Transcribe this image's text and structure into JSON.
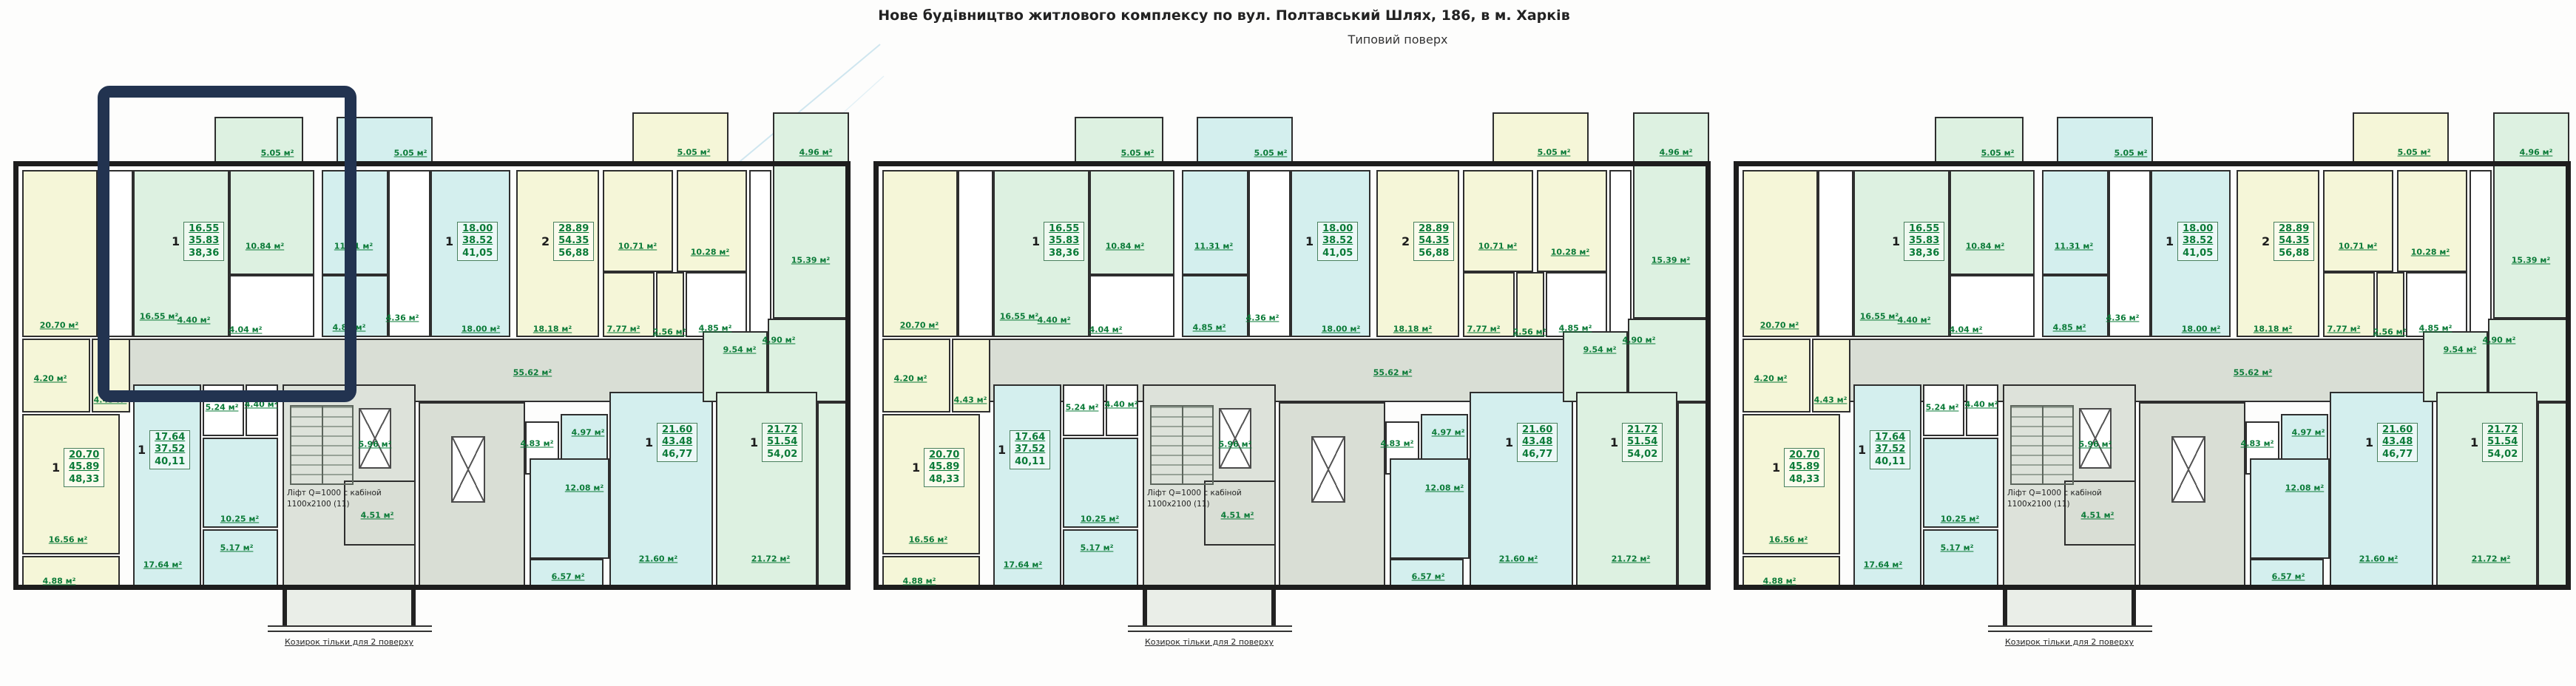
{
  "header": {
    "title": "Нове будівництво житлового комплексу по вул. Полтавський Шлях, 186, в м. Харків",
    "subtitle": "Типовий поверх"
  },
  "notes": {
    "lift_line1": "Ліфт Q=1000 с кабіной",
    "lift_line2": "1100х2100  (11)",
    "canopy": "Козирок тільки для 2 поверху"
  },
  "colors": {
    "pale_yellow": "#f5f6d8",
    "pale_green": "#ddf1e1",
    "pale_cyan": "#d4efee",
    "corridor_gray": "#d9ded5",
    "stair_gray": "#dde2da",
    "white": "#ffffff",
    "wall_dark": "#2e2e2e",
    "label_green": "#0b7b38",
    "highlight_navy": "#223350"
  },
  "sections": [
    {
      "name": "section-1"
    },
    {
      "name": "section-2"
    },
    {
      "name": "section-3"
    }
  ],
  "area_labels": [
    "5.05 м²",
    "5.05 м²",
    "5.05 м²",
    "4.96 м²",
    "20.70 м²",
    "16.55 м²",
    "10.84 м²",
    "4.40 м²",
    "4.04 м²",
    "11.31 м²",
    "4.85 м²",
    "4.36 м²",
    "18.00 м²",
    "18.18 м²",
    "10.71 м²",
    "10.28 м²",
    "7.77 м²",
    "2.56 м²",
    "4.85 м²",
    "15.39 м²",
    "55.62 м²",
    "4.20 м²",
    "4.43 м²",
    "16.56 м²",
    "4.88 м²",
    "5.24 м²",
    "4.40 м²",
    "17.64 м²",
    "10.25 м²",
    "5.17 м²",
    "5.96 м²",
    "4.51 м²",
    "4.83 м²",
    "4.97 м²",
    "12.08 м²",
    "21.60 м²",
    "6.57 м²",
    "9.54 м²",
    "4.90 м²",
    "21.72 м²"
  ],
  "apartments": [
    {
      "rooms": "1",
      "line1": "16.55",
      "line2": "35.83",
      "line3": "38,36"
    },
    {
      "rooms": "1",
      "line1": "18.00",
      "line2": "38.52",
      "line3": "41,05"
    },
    {
      "rooms": "2",
      "line1": "28.89",
      "line2": "54.35",
      "line3": "56,88"
    },
    {
      "rooms": "1",
      "line1": "20.70",
      "line2": "45.89",
      "line3": "48,33"
    },
    {
      "rooms": "1",
      "line1": "17.64",
      "line2": "37.52",
      "line3": "40,11"
    },
    {
      "rooms": "1",
      "line1": "21.60",
      "line2": "43.48",
      "line3": "46,77"
    },
    {
      "rooms": "1",
      "line1": "21.72",
      "line2": "51.54",
      "line3": "54,02"
    }
  ]
}
